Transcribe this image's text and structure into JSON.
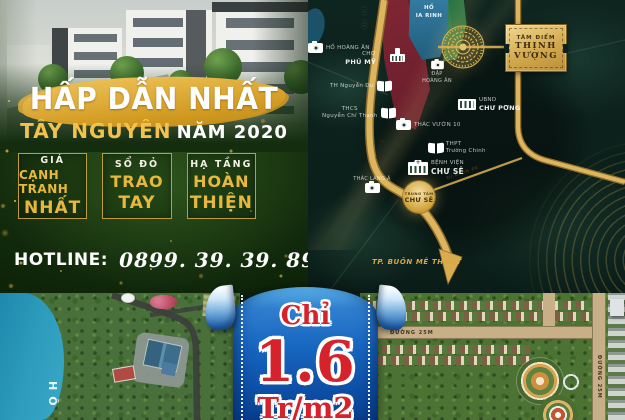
{
  "promo": {
    "headline": "HẤP DẪN NHẤT",
    "subheadline_strong": "TÂY NGUYÊN",
    "subheadline_rest": "NĂM 2020",
    "features": [
      {
        "top": "GIÁ",
        "mid": "CẠNH TRANH",
        "bottom": "NHẤT"
      },
      {
        "top": "SỔ ĐỎ",
        "mid": "TRAO",
        "bottom": "TAY"
      },
      {
        "top": "HẠ TẦNG",
        "mid": "HOÀN",
        "bottom": "THIỆN"
      }
    ],
    "hotline_label": "HOTLINE:",
    "hotline_number": "0899. 39. 39. 89"
  },
  "map": {
    "lake": {
      "line1": "HỒ",
      "line2": "IA RINH"
    },
    "badge": {
      "line1": "TÂM ĐIỂM",
      "line2": "THỊNH",
      "line3": "VƯỢNG"
    },
    "center_marker": {
      "line1": "TRUNG TÂM",
      "line2": "CHƯ SÊ"
    },
    "road_labels": {
      "ql14_top": "QL 14",
      "ql14_mid": "QL 14",
      "ayun_pa": "ĐI AYUN PA"
    },
    "destination": "TP. BUÔN MÊ THUỘT",
    "pois": [
      {
        "icon": "camera-icon",
        "small": "",
        "name": "HỒ HOÀNG ÂN"
      },
      {
        "icon": "",
        "small": "CHỢ",
        "name": "PHÚ MỸ"
      },
      {
        "icon": "book-icon",
        "small": "",
        "name": "TH Nguyễn Du"
      },
      {
        "icon": "book-icon",
        "small": "THCS",
        "name": "Nguyễn Chí Thanh"
      },
      {
        "icon": "camera-icon",
        "small": "ĐẬP",
        "name": "HOÀNG ÂN"
      },
      {
        "icon": "building-icon",
        "small": "UBND",
        "name": "CHƯ PƠNG"
      },
      {
        "icon": "camera-icon",
        "small": "",
        "name": "THÁC VƯỜN 10"
      },
      {
        "icon": "book-icon",
        "small": "THPT",
        "name": "Trường Chinh"
      },
      {
        "icon": "hospital-icon",
        "small": "BỆNH VIỆN",
        "name": "CHƯ SÊ"
      },
      {
        "icon": "camera-icon",
        "small": "",
        "name": "THÁC LÀNG Á"
      }
    ]
  },
  "price_banner": {
    "prefix": "Chỉ",
    "value": "1.6",
    "unit": "Tr/m2"
  },
  "aerial": {
    "lake_label": "HỒ"
  },
  "masterplan": {
    "street_horizontal": "ĐƯỜNG 25M",
    "street_vertical": "ĐƯỜNG 25M"
  },
  "colors": {
    "gold": "#d4a843",
    "dark_green": "#132d0e",
    "map_teal": "#0d211c",
    "ribbon_blue": "#1565c0",
    "price_red": "#d6232b",
    "road_gold": "#d9ad4f",
    "zone_red": "#7b2230",
    "lake_blue": "#2e7191"
  }
}
